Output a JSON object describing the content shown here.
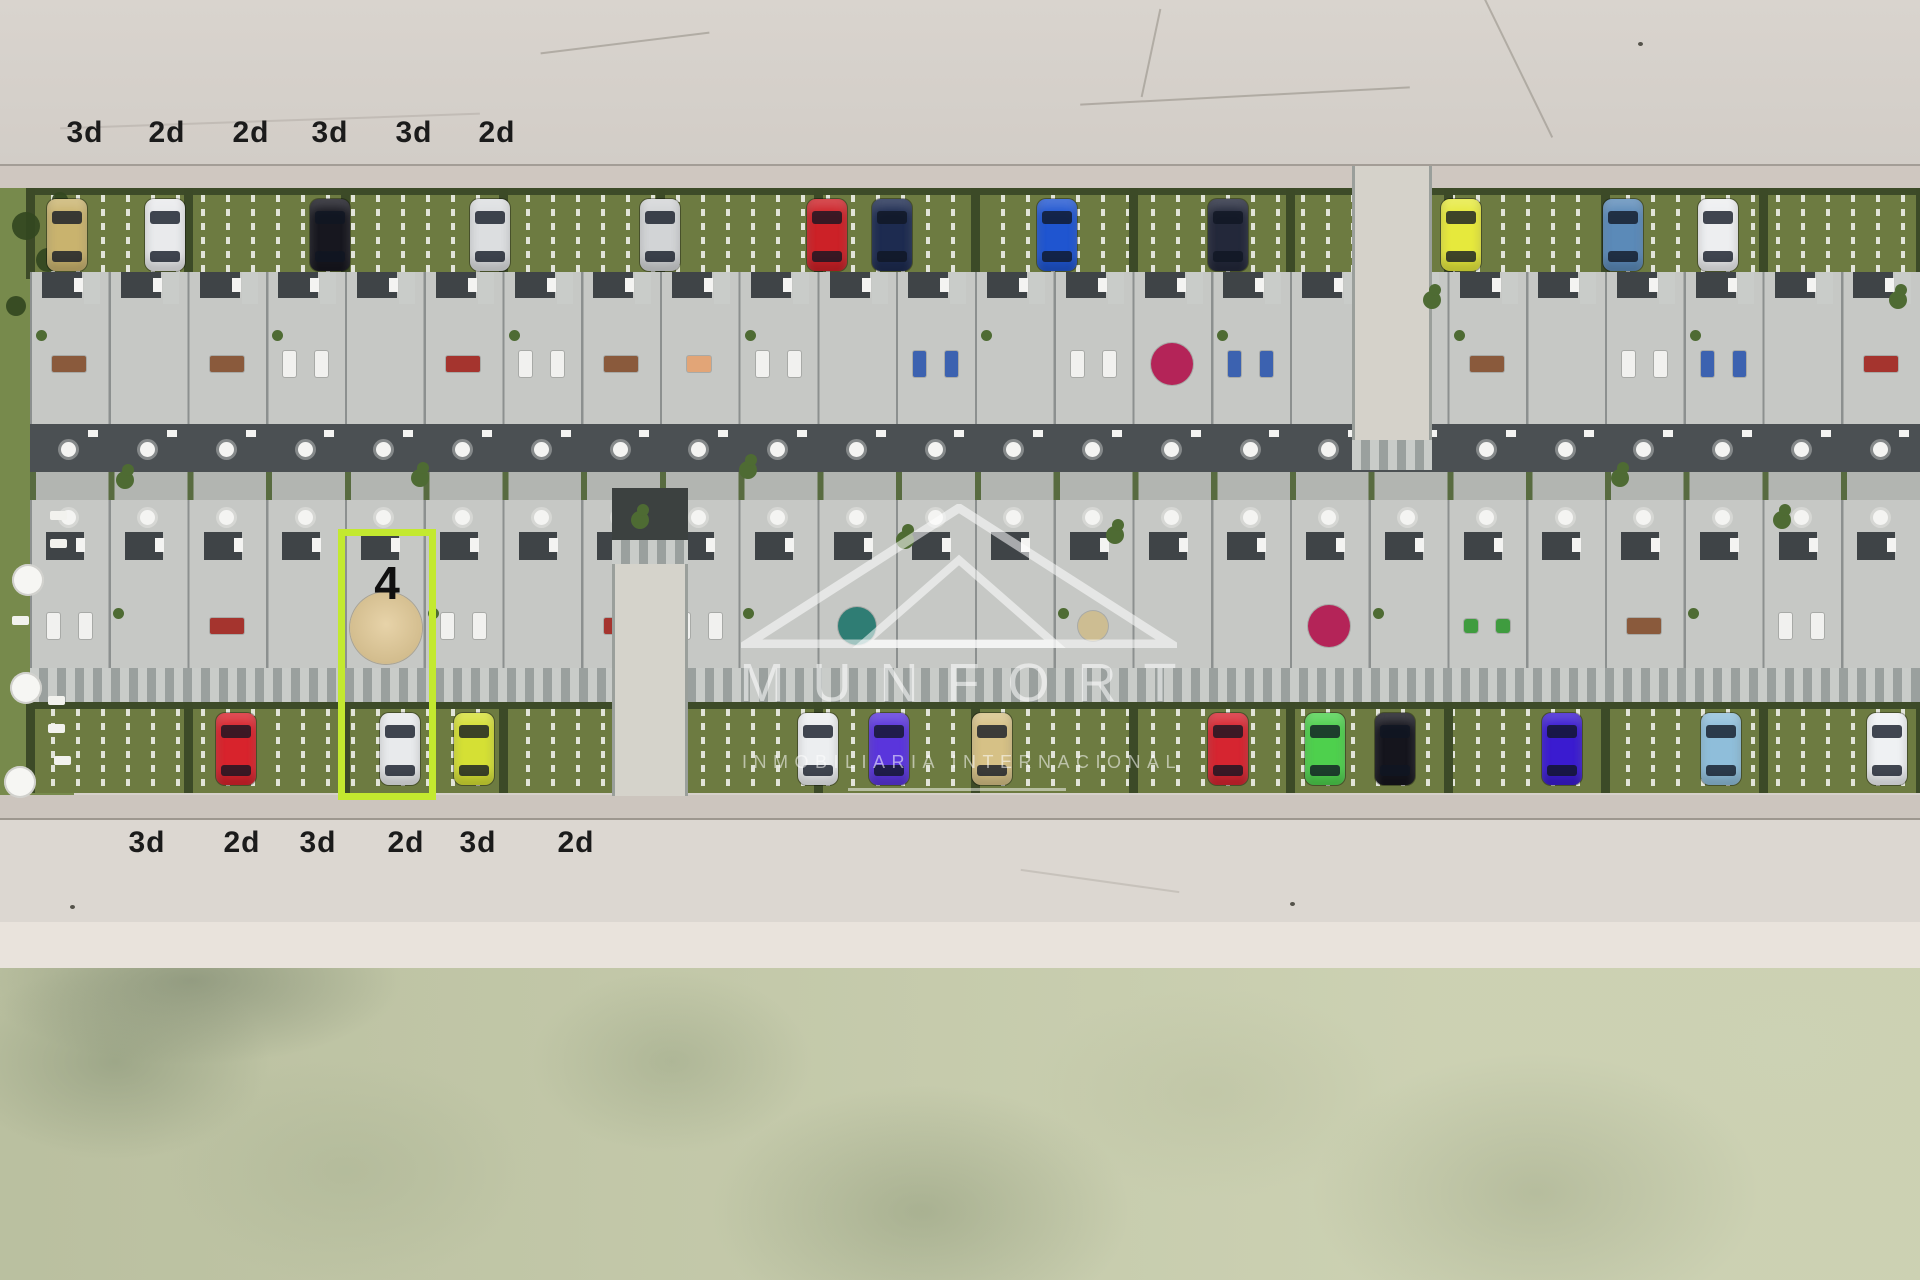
{
  "labels": {
    "top": [
      {
        "text": "3d",
        "x": 85
      },
      {
        "text": "2d",
        "x": 167
      },
      {
        "text": "2d",
        "x": 251
      },
      {
        "text": "3d",
        "x": 330
      },
      {
        "text": "3d",
        "x": 414
      },
      {
        "text": "2d",
        "x": 497
      }
    ],
    "top_y": 133,
    "bottom": [
      {
        "text": "3d",
        "x": 147
      },
      {
        "text": "2d",
        "x": 242
      },
      {
        "text": "3d",
        "x": 318
      },
      {
        "text": "2d",
        "x": 406
      },
      {
        "text": "3d",
        "x": 478
      },
      {
        "text": "2d",
        "x": 576
      }
    ],
    "bottom_y": 843
  },
  "highlight": {
    "unit_label": "4",
    "color": "#c3e92f",
    "x": 338,
    "y": 529,
    "width": 98,
    "height": 271
  },
  "watermark": {
    "brand": "MUNFORT",
    "subtitle": "INMOBILIARIA INTERNACIONAL"
  },
  "parking": {
    "north_cars": [
      {
        "x": 67,
        "color": "#c9b36e"
      },
      {
        "x": 165,
        "color": "#e9eaec"
      },
      {
        "x": 330,
        "color": "#17171f"
      },
      {
        "x": 490,
        "color": "#dcdee0"
      },
      {
        "x": 660,
        "color": "#d2d4d6"
      },
      {
        "x": 827,
        "color": "#cc2127"
      },
      {
        "x": 892,
        "color": "#1d2b50"
      },
      {
        "x": 1057,
        "color": "#1f55d0"
      },
      {
        "x": 1228,
        "color": "#23283a"
      },
      {
        "x": 1461,
        "color": "#e6e93c"
      },
      {
        "x": 1623,
        "color": "#5b8ab8"
      },
      {
        "x": 1718,
        "color": "#edeef0"
      }
    ],
    "south_cars": [
      {
        "x": 236,
        "color": "#d8232c"
      },
      {
        "x": 400,
        "color": "#e8eaec"
      },
      {
        "x": 474,
        "color": "#d5e034"
      },
      {
        "x": 818,
        "color": "#eceef0"
      },
      {
        "x": 889,
        "color": "#5a35dc"
      },
      {
        "x": 992,
        "color": "#d6c186"
      },
      {
        "x": 1228,
        "color": "#d62530"
      },
      {
        "x": 1325,
        "color": "#4ed04d"
      },
      {
        "x": 1395,
        "color": "#15151d"
      },
      {
        "x": 1562,
        "color": "#3a1bd0"
      },
      {
        "x": 1721,
        "color": "#8fbeda"
      },
      {
        "x": 1887,
        "color": "#eff1f3"
      }
    ]
  },
  "complex": {
    "units_per_row": 24
  },
  "decor": {
    "top": [
      "brown",
      "none",
      "brown",
      "white",
      "none",
      "red",
      "white",
      "brown",
      "peach",
      "white",
      "none",
      "blue",
      "none",
      "white",
      "crimson",
      "blue",
      "none",
      "red",
      "brown",
      "none",
      "white",
      "blue",
      "none",
      "red"
    ],
    "bottom": [
      "white",
      "none",
      "red",
      "none",
      "none",
      "white",
      "none",
      "red",
      "white",
      "none",
      "teal",
      "none",
      "none",
      "tan",
      "none",
      "none",
      "crimson",
      "none",
      "green",
      "none",
      "brown",
      "none",
      "white",
      "none"
    ]
  },
  "garden_trees": [
    {
      "x": 125,
      "y": 480
    },
    {
      "x": 420,
      "y": 478
    },
    {
      "x": 640,
      "y": 520
    },
    {
      "x": 748,
      "y": 470
    },
    {
      "x": 905,
      "y": 540
    },
    {
      "x": 1115,
      "y": 535
    },
    {
      "x": 1620,
      "y": 478
    },
    {
      "x": 1782,
      "y": 520
    },
    {
      "x": 1432,
      "y": 300
    },
    {
      "x": 1898,
      "y": 300
    }
  ],
  "leisure": {
    "umbrellas": [
      {
        "x": 28,
        "y": 580
      },
      {
        "x": 26,
        "y": 688
      },
      {
        "x": 20,
        "y": 782
      }
    ],
    "loungers": [
      {
        "x": 58,
        "y": 515
      },
      {
        "x": 58,
        "y": 543
      },
      {
        "x": 20,
        "y": 620
      },
      {
        "x": 56,
        "y": 700
      },
      {
        "x": 56,
        "y": 728
      },
      {
        "x": 62,
        "y": 760
      }
    ]
  },
  "palette": {
    "road": "#d6d1cb",
    "road_lower": "#dcd7d1",
    "sand_strip": "#e9e3dc",
    "beach": "#c6cbab",
    "parking_green": "#6d7b41",
    "hedge": "#3d4b28",
    "roof": "#c6c8c5",
    "roof_dark": "#454a4d",
    "walk": "#b4b7b4",
    "grass": "#778a4c",
    "highlight": "#c3e92f",
    "label_color": "#1b1b1b"
  }
}
